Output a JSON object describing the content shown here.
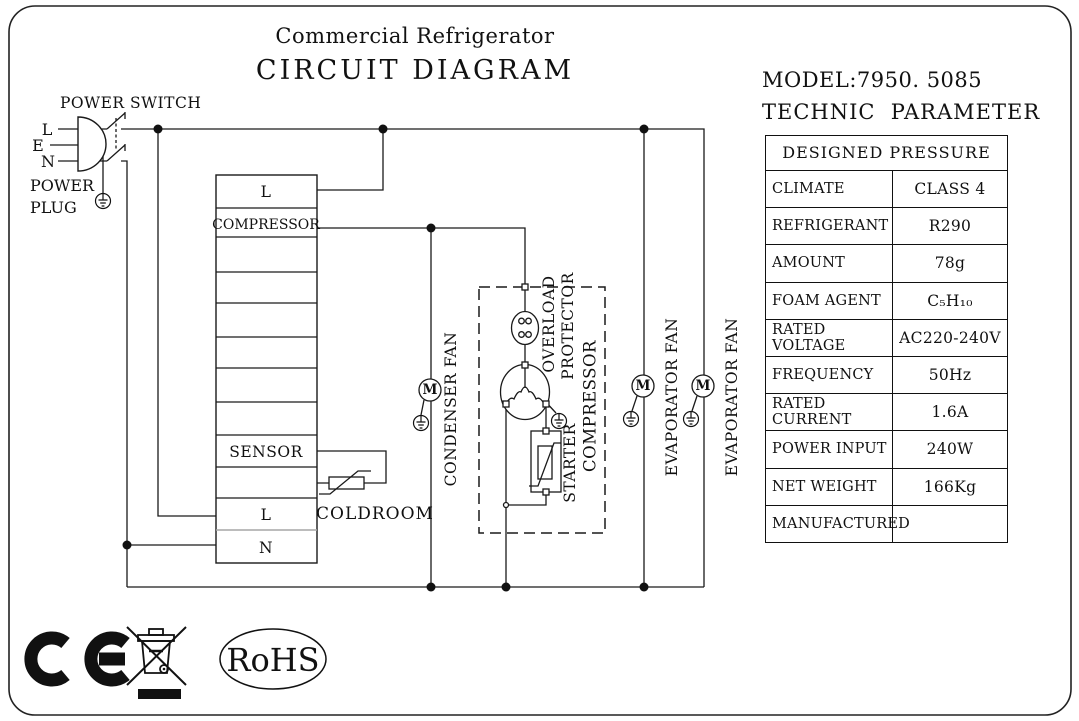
{
  "title": {
    "line1": "Commercial Refrigerator",
    "line2": "CIRCUIT DIAGRAM"
  },
  "panel": {
    "model": "MODEL:7950. 5085",
    "technic": "TECHNIC  PARAMETER",
    "table": {
      "header": "DESIGNED PRESSURE",
      "rows": [
        {
          "label": "CLIMATE",
          "value": "CLASS 4"
        },
        {
          "label": "REFRIGERANT",
          "value": "R290"
        },
        {
          "label": "AMOUNT",
          "value": "78g"
        },
        {
          "label": "FOAM AGENT",
          "value": "C₅H₁₀"
        },
        {
          "label": "RATED VOLTAGE",
          "value": "AC220-240V"
        },
        {
          "label": "FREQUENCY",
          "value": "50Hz"
        },
        {
          "label": "RATED CURRENT",
          "value": "1.6A"
        },
        {
          "label": "POWER INPUT",
          "value": "240W"
        },
        {
          "label": "NET WEIGHT",
          "value": "166Kg"
        },
        {
          "label": "MANUFACTURED",
          "value": ""
        }
      ]
    }
  },
  "diagram": {
    "power_switch": "POWER SWITCH",
    "power_plug": [
      "POWER",
      "PLUG"
    ],
    "pins": {
      "l": "L",
      "e": "E",
      "n": "N"
    },
    "terminal_rows": [
      "L",
      "COMPRESSOR",
      "",
      "",
      "",
      "",
      "",
      "",
      "SENSOR",
      "",
      "L",
      "N"
    ],
    "coldroom": "COLDROOM",
    "condenser_fan": "CONDENSER FAN",
    "evaporator_fan": "EVAPORATOR FAN",
    "overload_protector": [
      "OVERLOAD",
      "PROTECTOR"
    ],
    "compressor": "COMPRESSOR",
    "starter": "STARTER",
    "motor": "M"
  },
  "footer": {
    "ce": "CE",
    "rohs": "RoHS"
  },
  "colors": {
    "ink": "#111111",
    "background": "#ffffff"
  }
}
